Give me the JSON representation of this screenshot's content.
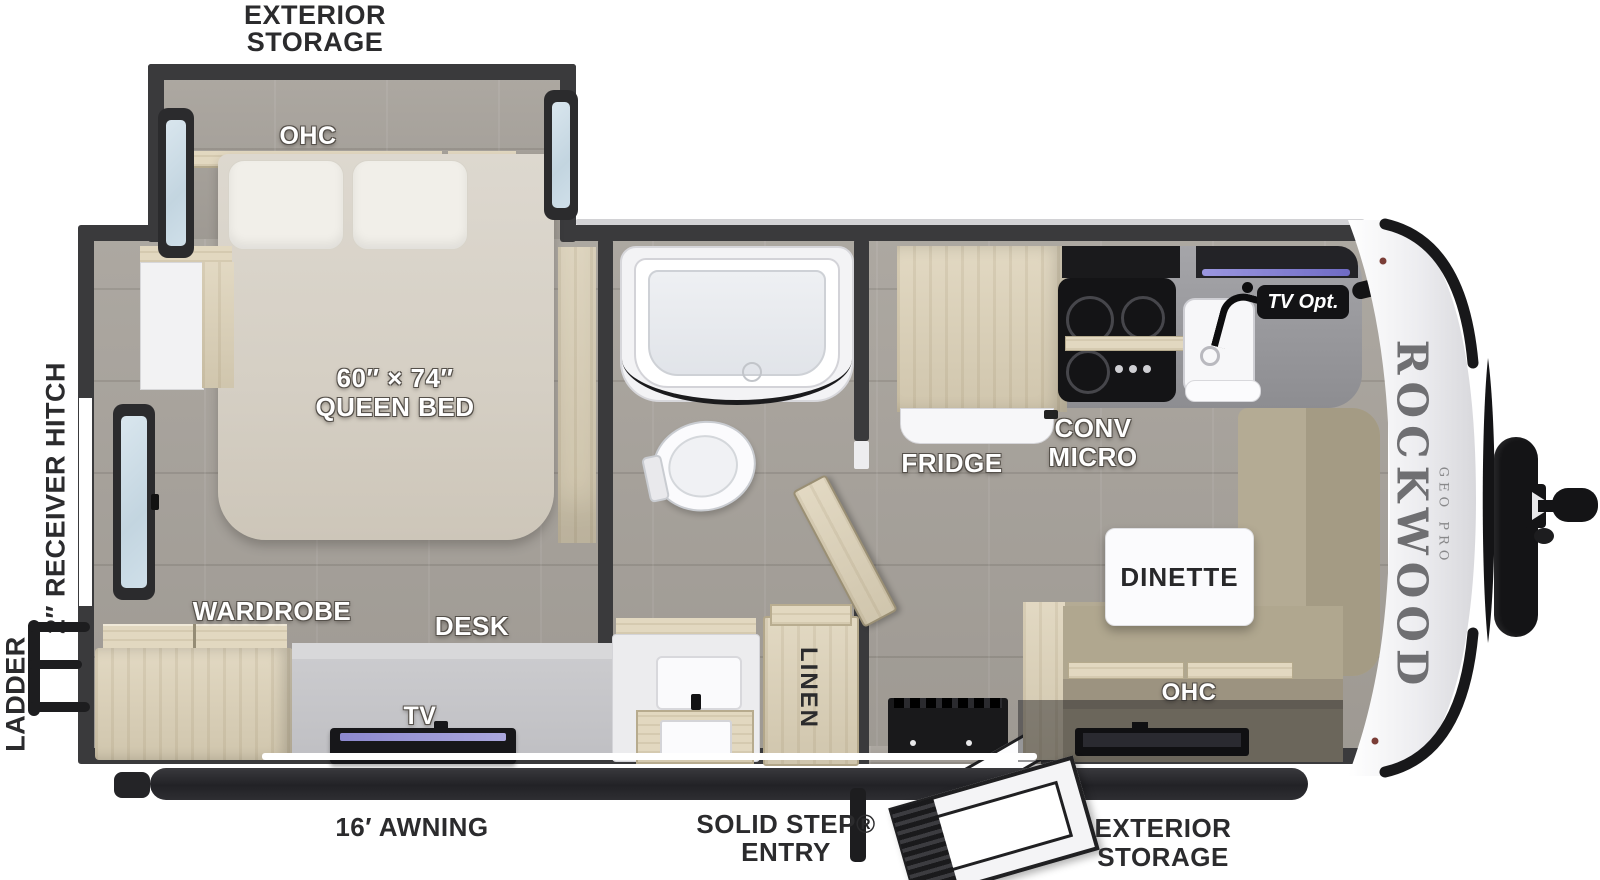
{
  "plan": {
    "brand": "ROCKWOOD",
    "brand_sub": "GEO PRO",
    "exterior_labels": {
      "storage_top": "EXTERIOR\nSTORAGE",
      "storage_bottom": "EXTERIOR\nSTORAGE",
      "ladder": "LADDER",
      "receiver_hitch": "2″ RECEIVER HITCH",
      "awning": "16′ AWNING",
      "entry": "SOLID STEP®\nENTRY"
    },
    "room_labels": {
      "ohc_bedroom": "OHC",
      "bed_size": "60″ × 74″",
      "bed_type": "QUEEN BED",
      "wardrobe": "WARDROBE",
      "desk": "DESK",
      "tv_desk": "TV",
      "linen": "LINEN",
      "fridge": "FRIDGE",
      "conv_micro": "CONV\nMICRO",
      "tv_opt": "TV Opt.",
      "dinette": "DINETTE",
      "ohc_dinette": "OHC"
    },
    "colors": {
      "wall": "#3a3a3c",
      "floor": "#a8a39c",
      "wood": "#ddd2b8",
      "cushion": "#b4ab94",
      "counter": "#97979b",
      "led_accent": "#8f8bd6",
      "label_dark": "#2b2b2d"
    }
  }
}
